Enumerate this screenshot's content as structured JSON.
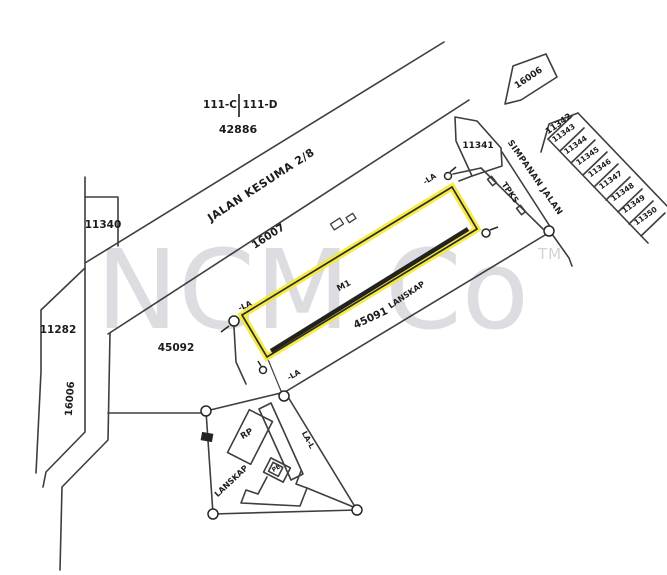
{
  "title_block": {
    "parcel_left": "111-C",
    "parcel_right": "111-D",
    "parcel_number": "42886"
  },
  "watermark": {
    "brand": "NCM Co",
    "tm": "TM"
  },
  "colors": {
    "highlight": "#f6e82b",
    "line": "#2e2e2e",
    "watermark": "#c0c0c9"
  },
  "roads": {
    "jalan_kesuma_name": "JALAN KESUMA 2/8",
    "jalan_kesuma_lot": "16007",
    "west_road_lot": "16006",
    "sign_arrow_lot": "16006",
    "simpanan_jalan": "SIMPANAN JALAN",
    "tpks_strip": "TPKS"
  },
  "plots": {
    "p11340": "11340",
    "p11282": "11282",
    "p45092": "45092",
    "p45091": "45091",
    "p11341": "11341",
    "p11342": "11342",
    "strip_cells": [
      "11343",
      "11344",
      "11345",
      "11346",
      "11347",
      "11348",
      "11349",
      "11350"
    ],
    "highlight_label": "M1",
    "lanskap_ne": "LANSKAP",
    "lanskap_sw": "LANSKAP",
    "rp_box": "RP",
    "pe_box": "PE"
  },
  "survey_marks": {
    "la_west": "-LA",
    "la_north": "-LA",
    "la_south": "-LA",
    "la_edge": "LA-L"
  }
}
